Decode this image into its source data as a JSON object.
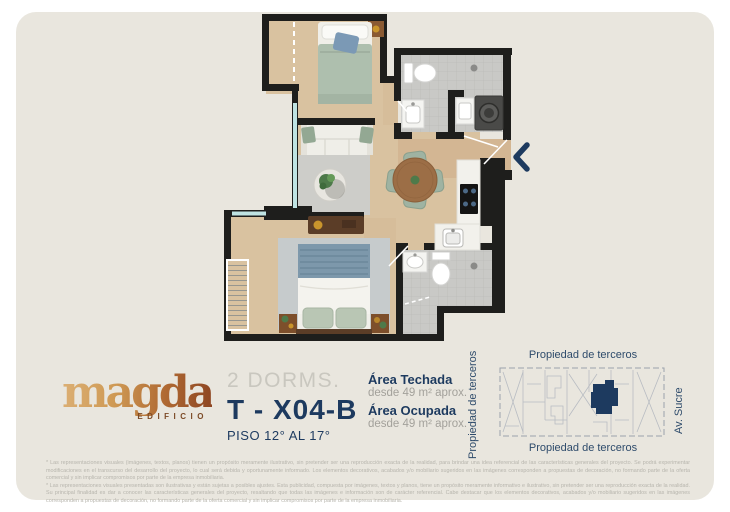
{
  "page": {
    "background_color": "#e9e6de",
    "frame_color": "#ffffff"
  },
  "logo": {
    "name": "magda",
    "subtitle": "EDIFICIO",
    "gradient": [
      "#dcb075",
      "#8d4522"
    ]
  },
  "unit": {
    "dorms_label": "2 DORMS.",
    "code": "T - X04-B",
    "floors_label": "PISO 12° AL 17°"
  },
  "areas": {
    "techada_label": "Área Techada",
    "techada_value": "desde 49 m² aprox.",
    "ocupada_label": "Área Ocupada",
    "ocupada_value": "desde 49 m² aprox."
  },
  "key_plan": {
    "label_top": "Propiedad de terceros",
    "label_bottom": "Propiedad de terceros",
    "label_left": "Propiedad de terceros",
    "label_right": "Av. Sucre",
    "unit_highlight_color": "#1d3a5f"
  },
  "floor_plan": {
    "rooms": [
      "bedroom-1",
      "living-room",
      "dining-area",
      "kitchen",
      "bathroom-1",
      "laundry",
      "bathroom-2",
      "master-bedroom",
      "entry-corridor"
    ],
    "entry_marker": "chevron-left",
    "wall_color": "#1e1e1c",
    "wood_floor_color": "#d9c2a0",
    "tile_floor_color": "#c9c9c6",
    "accent_navy": "#1d3a5f"
  },
  "disclaimer": {
    "p1": "* Las representaciones visuales (imágenes, textos, planos) tienen un propósito meramente ilustrativo, sin pretender ser una reproducción exacta de la realidad, para brindar una idea referencial de las características generales del proyecto. Se podrá experimentar modificaciones en el transcurso del desarrollo del proyecto, lo cual será debida y oportunamente informado. Los elementos decorativos, acabados y/o mobiliario sugeridos en las imágenes corresponden a propuestas de decoración, no formando parte de la oferta comercial y sin implicar compromisos por parte de la empresa inmobiliaria.",
    "p2": "* Las representaciones visuales presentadas son ilustrativas y están sujetas a posibles ajustes. Esta publicidad, compuesta por imágenes, textos y planos, tiene un propósito meramente informativo e ilustrativo, sin pretender ser una reproducción exacta de la realidad. Su principal finalidad es dar a conocer las características generales del proyecto, resaltando que todas las imágenes e información son de carácter referencial. Cabe destacar que los elementos decorativos, acabados y/o mobiliario sugeridos en las imágenes corresponden a propuestas de decoración, no formando parte de la oferta comercial y sin implicar compromisos por parte de la empresa inmobiliaria."
  }
}
